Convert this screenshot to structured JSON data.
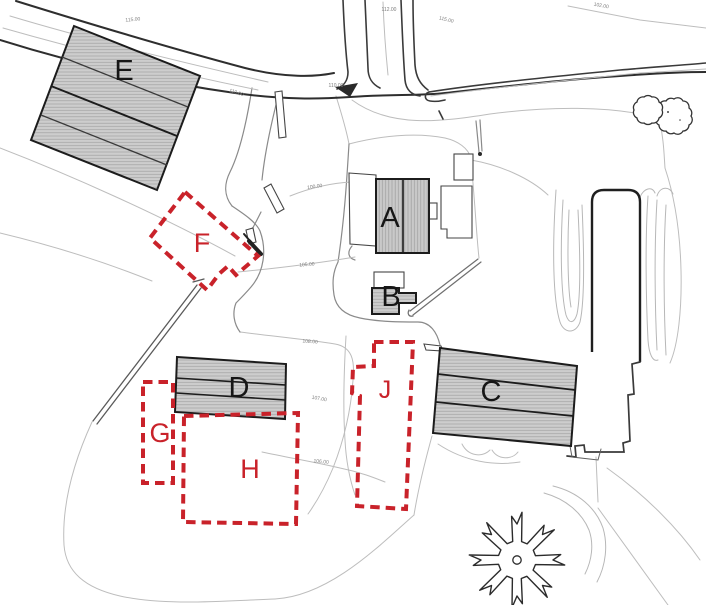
{
  "plan": {
    "description": "hand-drawn farmstead site plan sketch",
    "colors": {
      "proposed_outline": "#c9222a",
      "existing_fill": "#cdcdcd",
      "hatch_line": "#9f9f9f",
      "line_dark": "#2e2e2e",
      "line_light": "#bdbdbd",
      "letter_dark": "#161616"
    },
    "buildings_existing": [
      {
        "label": "E"
      },
      {
        "label": "A"
      },
      {
        "label": "B"
      },
      {
        "label": "C"
      },
      {
        "label": "D"
      }
    ],
    "buildings_proposed": [
      {
        "label": "F"
      },
      {
        "label": "G"
      },
      {
        "label": "H"
      },
      {
        "label": "J"
      }
    ],
    "elevation_labels": [
      {
        "text": "115.00"
      },
      {
        "text": "112.00"
      },
      {
        "text": "115.00"
      },
      {
        "text": "110.00"
      },
      {
        "text": "110.00"
      },
      {
        "text": "102.00"
      },
      {
        "text": "100.00"
      },
      {
        "text": "105.00"
      },
      {
        "text": "108.00"
      },
      {
        "text": "107.00"
      },
      {
        "text": "106.00"
      }
    ]
  }
}
